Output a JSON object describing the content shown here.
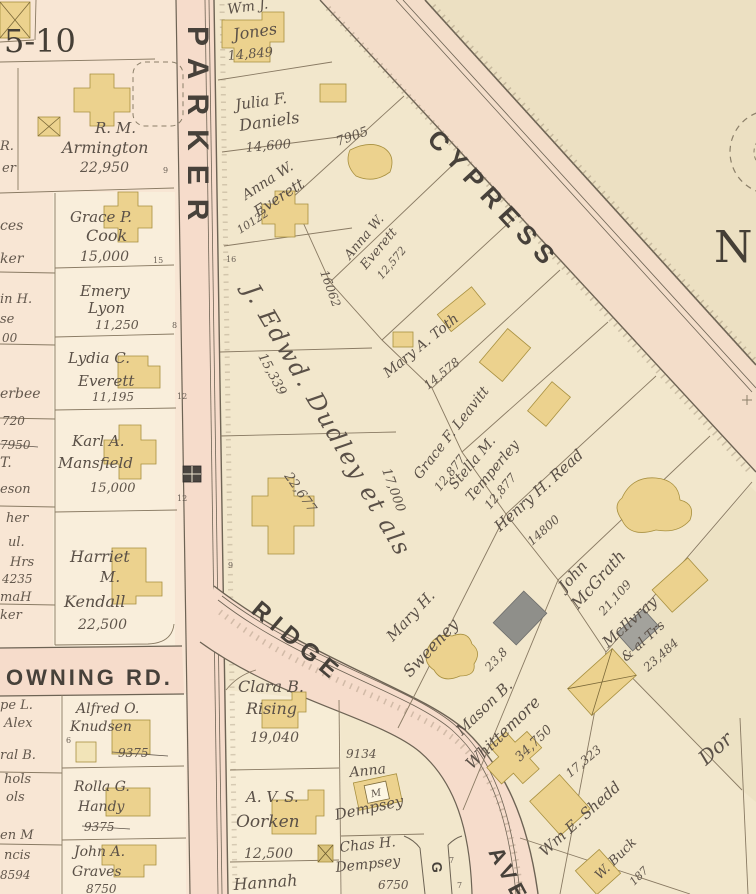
{
  "map": {
    "block_number": "5-10",
    "compass": "N",
    "streets": {
      "parker": "PARKER",
      "cypress": "CYPRESS",
      "ridge": "RIDGE",
      "ridge_ave": "AVE",
      "downing_rd": "OWNING RD.",
      "side_fragment": "G"
    },
    "colors": {
      "paper": "#efe4c8",
      "open_land": "#ece0c2",
      "road_fill": "#f6dccb",
      "parcel_light": "#f9eedb",
      "house_yellow": "#ecd28e",
      "house_gray": "#8f8f8a",
      "line": "#897a63",
      "ink": "#5a5047"
    },
    "parcels": {
      "armington": {
        "l1": "R. M.",
        "l2": "Armington",
        "area": "22,950"
      },
      "cook": {
        "l1": "Grace P.",
        "l2": "Cook",
        "area": "15,000"
      },
      "lyon": {
        "l1": "Emery",
        "l2": "Lyon",
        "area": "11,250"
      },
      "everett_lydia": {
        "l1": "Lydia C.",
        "l2": "Everett",
        "area": "11,195"
      },
      "mansfield": {
        "l1": "Karl A.",
        "l2": "Mansfield",
        "area": "15,000"
      },
      "kendall": {
        "l1": "Harriet",
        "l2": "M.",
        "l3": "Kendall",
        "area": "22,500"
      },
      "knudsen": {
        "l1": "Alfred O.",
        "l2": "Knudsen",
        "area": "9375"
      },
      "handy": {
        "l1": "Rolla G.",
        "l2": "Handy",
        "area": "9375"
      },
      "graves": {
        "l1": "John A.",
        "l2": "Graves",
        "area": "8750"
      },
      "jones": {
        "l1": "Wm J.",
        "l2": "Jones",
        "area": "14,849"
      },
      "daniels": {
        "l1": "Julia F.",
        "l2": "Daniels",
        "area": "14,600"
      },
      "everett_anna_1": {
        "l1": "Anna W.",
        "l2": "Everett",
        "area": "10122",
        "house_no": "7905"
      },
      "everett_anna_2": {
        "l1": "Anna W.",
        "l2": "Everett",
        "area": "12,572"
      },
      "dudley": {
        "name": "J. Edwd. Dudley et als",
        "a1": "16062",
        "a2": "15,339",
        "a3": "22,677",
        "a4": "17,000"
      },
      "toth": {
        "l1": "Mary A. Toth",
        "area": "14,578"
      },
      "leavitt": {
        "l1": "Grace F. Leavitt",
        "area": "12,877"
      },
      "temperley": {
        "l1": "Stella M.",
        "l2": "Temperley",
        "area": "12,877"
      },
      "read": {
        "l1": "Henry H. Read",
        "area": "14800"
      },
      "mcgrath": {
        "l1": "John",
        "l2": "McGrath",
        "area": "21,109"
      },
      "mcilvray": {
        "l1": "McIlvray",
        "l2": "& al Trs",
        "area": "23,484"
      },
      "sweeney": {
        "l1": "Mary H.",
        "l2": "Sweeney",
        "area": "23,8"
      },
      "whittemore": {
        "l1": "Mason B.",
        "l2": "Whittemore",
        "area": "34,750"
      },
      "shedd": {
        "area": "17,323",
        "l1": "Wm E. Shedd"
      },
      "buck": {
        "l1": "W. Buck",
        "area": "187"
      },
      "dor_fragment": {
        "l1": "Dor"
      },
      "rising": {
        "l1": "Clara B.",
        "l2": "Rising",
        "area": "19,040"
      },
      "oorken": {
        "l1": "A. V. S.",
        "l2": "Oorken",
        "area": "12,500"
      },
      "hannah": {
        "l1": "Hannah"
      },
      "dempsey_anna": {
        "house_no": "9134",
        "l1": "Anna",
        "l2": "Dempsey",
        "house_letter": "M"
      },
      "dempsey_chas": {
        "l1": "Chas H.",
        "l2": "Dempsey",
        "area": "6750"
      }
    },
    "edge_fragments": [
      "R.",
      "er",
      "ces",
      "ker",
      "in H.",
      "se",
      "00",
      "erbee",
      "720",
      "7950",
      "T.",
      "eson",
      "her",
      "ul.",
      "Hrs",
      "4235",
      "maH",
      "ker",
      "pe L.",
      "Alex",
      "ral B.",
      "hols",
      "ols",
      "en M",
      "ncis",
      "8594"
    ],
    "lot_numbers": [
      "9",
      "15",
      "8",
      "12",
      "12",
      "16",
      "9",
      "6",
      "7",
      "7"
    ]
  }
}
